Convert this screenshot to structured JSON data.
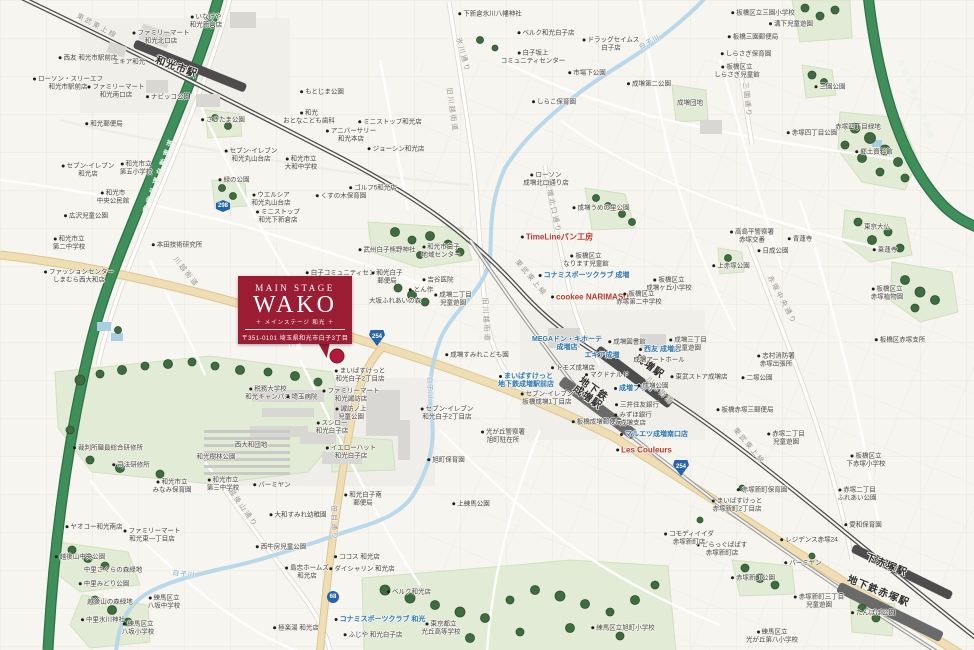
{
  "callout": {
    "en_small": "MAIN STAGE",
    "en_large": "WAKO",
    "subtitle": "＋ メインステージ 和光 ＋",
    "address": "〒351-0101 埼玉県和光市白子3丁目10番"
  },
  "colors": {
    "brand_red": "#9a1d34",
    "shop_blue": "#2878b4",
    "accent_red": "#c0392b",
    "expressway_green": "#3f8f5b",
    "railway_gray": "#4c4c4c",
    "river_blue": "#b5d6e8",
    "park_green": "#e2ebd5",
    "road_badge_blue": "#2563ab"
  },
  "badges": [
    {
      "t": "298",
      "shape": "hex",
      "x": 223,
      "y": 206
    },
    {
      "t": "254",
      "shape": "tri",
      "x": 377,
      "y": 338
    },
    {
      "t": "254",
      "shape": "tri",
      "x": 681,
      "y": 468
    },
    {
      "t": "68",
      "shape": "circle",
      "x": 333,
      "y": 597
    }
  ],
  "labels": [
    {
      "t": "和光市駅",
      "x": 176,
      "y": 68,
      "c": "station",
      "r": 20
    },
    {
      "t": "成増駅",
      "x": 649,
      "y": 367,
      "c": "station",
      "r": 36
    },
    {
      "t": "地下鉄\n成増駅",
      "x": 590,
      "y": 394,
      "c": "station",
      "r": 36
    },
    {
      "t": "下赤塚駅",
      "x": 886,
      "y": 566,
      "c": "station",
      "r": 22
    },
    {
      "t": "地下鉄赤塚駅",
      "x": 878,
      "y": 592,
      "c": "station",
      "r": 22
    },
    {
      "t": "東武東上線",
      "x": 97,
      "y": 26,
      "c": "road",
      "r": 28
    },
    {
      "t": "東武東上線",
      "x": 531,
      "y": 278,
      "c": "road",
      "r": 50
    },
    {
      "t": "東武東上線",
      "x": 749,
      "y": 446,
      "c": "road",
      "r": 50
    },
    {
      "t": "川越街道",
      "x": 186,
      "y": 272,
      "c": "road",
      "r": 52
    },
    {
      "t": "川越街道",
      "x": 660,
      "y": 391,
      "c": "road",
      "r": 45
    },
    {
      "t": "旧川越街道",
      "x": 452,
      "y": 110,
      "c": "road",
      "r": 82
    },
    {
      "t": "旧川越街道",
      "x": 486,
      "y": 320,
      "c": "road",
      "r": 87
    },
    {
      "t": "笹目通り",
      "x": 334,
      "y": 523,
      "c": "road",
      "r": 88
    },
    {
      "t": "氷川通り",
      "x": 463,
      "y": 55,
      "c": "road",
      "r": 75
    },
    {
      "t": "成増北口通り",
      "x": 553,
      "y": 207,
      "c": "road",
      "r": 78
    },
    {
      "t": "三園通り",
      "x": 747,
      "y": 100,
      "c": "road",
      "r": 84
    },
    {
      "t": "赤塚中央通り",
      "x": 782,
      "y": 300,
      "c": "road",
      "r": 62
    },
    {
      "t": "越後山通り",
      "x": 243,
      "y": 508,
      "c": "road",
      "r": 55
    },
    {
      "t": "東京外環自動車道",
      "x": 159,
      "y": 175,
      "c": "hwy",
      "r": -70
    },
    {
      "t": "首都高速5号池袋線",
      "x": 916,
      "y": 100,
      "c": "hwy",
      "r": 68
    },
    {
      "t": "白子川",
      "x": 649,
      "y": 41,
      "c": "river",
      "r": -30
    },
    {
      "t": "白子川",
      "x": 431,
      "y": 388,
      "c": "river",
      "r": 88
    },
    {
      "t": "白子川",
      "x": 184,
      "y": 573,
      "c": "river",
      "r": 6
    },
    {
      "t": "MEGAドン・キホーテ\n成増店",
      "x": 567,
      "y": 344,
      "c": "shop"
    },
    {
      "t": "エキア成増",
      "x": 602,
      "y": 356,
      "c": "shop"
    },
    {
      "t": "西友 成増店",
      "x": 660,
      "y": 350,
      "c": "shop",
      "d": 1
    },
    {
      "t": "成増プラザ",
      "x": 634,
      "y": 389,
      "c": "shop",
      "d": 1
    },
    {
      "t": "まいばすけっと\n地下鉄成増駅前店",
      "x": 526,
      "y": 381,
      "c": "shop",
      "d": 1
    },
    {
      "t": "マルエツ成増南口店",
      "x": 654,
      "y": 435,
      "c": "shop",
      "d": 1
    },
    {
      "t": "コナミスポーツクラブ 成増",
      "x": 584,
      "y": 276,
      "c": "shop",
      "d": 1
    },
    {
      "t": "コナミスポーツクラブ 和光",
      "x": 380,
      "y": 620,
      "c": "shop",
      "d": 1
    },
    {
      "t": "TimeLineパン工房",
      "x": 557,
      "y": 237,
      "c": "red",
      "d": 1
    },
    {
      "t": "cookee NARIMASU",
      "x": 590,
      "y": 297,
      "c": "red",
      "d": 1
    },
    {
      "t": "Les Couleurs",
      "x": 644,
      "y": 450,
      "c": "red",
      "d": 1
    },
    {
      "t": "いなげや\n和光新倉店",
      "x": 206,
      "y": 21,
      "c": "poi",
      "d": 1
    },
    {
      "t": "ファミリーマート\n和光北口店",
      "x": 161,
      "y": 37,
      "c": "poi",
      "d": 1
    },
    {
      "t": "西友 和光市駅前店",
      "x": 88,
      "y": 58,
      "c": "poi",
      "d": 1
    },
    {
      "t": "エキア和光",
      "x": 129,
      "y": 62,
      "c": "poi"
    },
    {
      "t": "ローソン・スリーエフ\n和光市駅前店",
      "x": 68,
      "y": 83,
      "c": "poi",
      "d": 1
    },
    {
      "t": "ファミリーマート\n和光南口店",
      "x": 116,
      "y": 91,
      "c": "poi",
      "d": 1
    },
    {
      "t": "和光郵便局",
      "x": 104,
      "y": 124,
      "c": "poi",
      "d": 1
    },
    {
      "t": "ナビッコ公園",
      "x": 168,
      "y": 97,
      "c": "poi",
      "d": 1
    },
    {
      "t": "もとじま公園",
      "x": 322,
      "y": 92,
      "c": "poi",
      "d": 1
    },
    {
      "t": "下新倉氷川八幡神社",
      "x": 490,
      "y": 14,
      "c": "poi",
      "d": 1
    },
    {
      "t": "ベルク和光白子店",
      "x": 546,
      "y": 33,
      "c": "poi",
      "d": 1
    },
    {
      "t": "白子坂上\nコミュニティセンター",
      "x": 533,
      "y": 57,
      "c": "poi",
      "d": 1
    },
    {
      "t": "ドラッグセイムス\n白子店",
      "x": 611,
      "y": 44,
      "c": "poi",
      "d": 1
    },
    {
      "t": "市場下公園",
      "x": 587,
      "y": 73,
      "c": "poi",
      "d": 1
    },
    {
      "t": "しらこ保育園",
      "x": 554,
      "y": 102,
      "c": "poi",
      "d": 1
    },
    {
      "t": "成増第二公園",
      "x": 649,
      "y": 84,
      "c": "poi",
      "d": 1
    },
    {
      "t": "成増団地",
      "x": 690,
      "y": 103,
      "c": "poi"
    },
    {
      "t": "板橋区立三園小学校",
      "x": 763,
      "y": 13,
      "c": "poi",
      "d": 1
    },
    {
      "t": "溝下児童遊園",
      "x": 791,
      "y": 24,
      "c": "poi",
      "d": 1
    },
    {
      "t": "板橋三園郵便局",
      "x": 753,
      "y": 37,
      "c": "poi",
      "d": 1
    },
    {
      "t": "しらさぎ保育園",
      "x": 746,
      "y": 54,
      "c": "poi",
      "d": 1
    },
    {
      "t": "板橋区立\nしらさぎ児童館",
      "x": 737,
      "y": 71,
      "c": "poi",
      "d": 1
    },
    {
      "t": "三園公園",
      "x": 830,
      "y": 87,
      "c": "poi",
      "d": 1
    },
    {
      "t": "赤塚四丁目公園",
      "x": 812,
      "y": 133,
      "c": "poi",
      "d": 1
    },
    {
      "t": "赤塚四丁目緑地",
      "x": 858,
      "y": 127,
      "c": "poi"
    },
    {
      "t": "郷土資料館",
      "x": 874,
      "y": 152,
      "c": "poi",
      "d": 1
    },
    {
      "t": "東京大仏",
      "x": 877,
      "y": 227,
      "c": "poi"
    },
    {
      "t": "乗蓮寺",
      "x": 885,
      "y": 250,
      "c": "poi",
      "d": 1
    },
    {
      "t": "青蓮寺",
      "x": 800,
      "y": 239,
      "c": "poi",
      "d": 1
    },
    {
      "t": "高島平警察署\n赤塚交番",
      "x": 752,
      "y": 236,
      "c": "poi",
      "d": 1
    },
    {
      "t": "日成公園",
      "x": 773,
      "y": 251,
      "c": "poi",
      "d": 1
    },
    {
      "t": "板橋区立\n赤塚植物園",
      "x": 887,
      "y": 293,
      "c": "poi",
      "d": 1
    },
    {
      "t": "板橋区赤塚支所",
      "x": 900,
      "y": 340,
      "c": "poi",
      "d": 1
    },
    {
      "t": "志村消防署\n赤塚出張所",
      "x": 776,
      "y": 360,
      "c": "poi",
      "d": 1
    },
    {
      "t": "二塚公園",
      "x": 757,
      "y": 378,
      "c": "poi",
      "d": 1
    },
    {
      "t": "板橋赤塚三郵便局",
      "x": 745,
      "y": 410,
      "c": "poi",
      "d": 1
    },
    {
      "t": "赤塚二丁目\n児童遊園",
      "x": 786,
      "y": 438,
      "c": "poi",
      "d": 1
    },
    {
      "t": "板橋区立\n下赤塚小学校",
      "x": 866,
      "y": 460,
      "c": "poi",
      "d": 1
    },
    {
      "t": "赤塚新町保育園",
      "x": 762,
      "y": 490,
      "c": "poi",
      "d": 1
    },
    {
      "t": "まいばすけっと\n赤塚新町2丁目店",
      "x": 737,
      "y": 505,
      "c": "poi",
      "d": 1
    },
    {
      "t": "赤塚二丁目\nふれあい公園",
      "x": 857,
      "y": 494,
      "c": "poi",
      "d": 1
    },
    {
      "t": "愛和保育園",
      "x": 863,
      "y": 525,
      "c": "poi",
      "d": 1
    },
    {
      "t": "レジデンス赤塚24",
      "x": 809,
      "y": 540,
      "c": "poi",
      "d": 1
    },
    {
      "t": "どらっぐぱぱす\n赤塚新町店",
      "x": 722,
      "y": 549,
      "c": "poi",
      "d": 1
    },
    {
      "t": "コモディイイダ\n赤塚新町店",
      "x": 689,
      "y": 538,
      "c": "poi",
      "d": 1
    },
    {
      "t": "バーミヤン",
      "x": 803,
      "y": 563,
      "c": "poi",
      "d": 1
    },
    {
      "t": "赤塚新町公園",
      "x": 753,
      "y": 578,
      "c": "poi",
      "d": 1
    },
    {
      "t": "赤塚新町三丁目\n児童遊園",
      "x": 819,
      "y": 601,
      "c": "poi",
      "d": 1
    },
    {
      "t": "たんぽぽ公園",
      "x": 873,
      "y": 613,
      "c": "poi",
      "d": 1
    },
    {
      "t": "練馬区立\n光が丘第八小学校",
      "x": 772,
      "y": 636,
      "c": "poi",
      "d": 1
    },
    {
      "t": "成増図書館",
      "x": 627,
      "y": 342,
      "c": "poi",
      "d": 1
    },
    {
      "t": "成増アートホール",
      "x": 659,
      "y": 360,
      "c": "poi"
    },
    {
      "t": "トモズ成増店",
      "x": 573,
      "y": 368,
      "c": "poi",
      "d": 1
    },
    {
      "t": "マクドナルド",
      "x": 607,
      "y": 375,
      "c": "poi",
      "d": 1
    },
    {
      "t": "三井住友銀行",
      "x": 637,
      "y": 405,
      "c": "poi",
      "d": 1
    },
    {
      "t": "みずほ銀行\n成増支店",
      "x": 633,
      "y": 419,
      "c": "poi",
      "d": 1
    },
    {
      "t": "セブン-イレブン\n板橋成増1丁目店",
      "x": 547,
      "y": 398,
      "c": "poi",
      "d": 1
    },
    {
      "t": "板橋成増郵便局",
      "x": 597,
      "y": 422,
      "c": "poi",
      "d": 1
    },
    {
      "t": "成増公園",
      "x": 653,
      "y": 386,
      "c": "poi",
      "d": 1
    },
    {
      "t": "東武ストア成増店",
      "x": 699,
      "y": 377,
      "c": "poi",
      "d": 1
    },
    {
      "t": "成増三丁目\n児童遊園",
      "x": 688,
      "y": 344,
      "c": "poi",
      "d": 1
    },
    {
      "t": "ローソン\n成増北口通り店",
      "x": 546,
      "y": 179,
      "c": "poi",
      "d": 1
    },
    {
      "t": "成増うめの里公園",
      "x": 601,
      "y": 208,
      "c": "poi",
      "d": 1
    },
    {
      "t": "板橋区立\nなります児童館",
      "x": 586,
      "y": 260,
      "c": "poi",
      "d": 1
    },
    {
      "t": "板橋区立\n成増ヶ丘小学校",
      "x": 669,
      "y": 284,
      "c": "poi",
      "d": 1
    },
    {
      "t": "板橋区立\n赤塚第二中学校",
      "x": 639,
      "y": 298,
      "c": "poi",
      "d": 1
    },
    {
      "t": "上赤塚公園",
      "x": 731,
      "y": 266,
      "c": "poi",
      "d": 1
    },
    {
      "t": "成増二丁目\n児童遊園",
      "x": 453,
      "y": 299,
      "c": "poi",
      "d": 1
    },
    {
      "t": "武州白子熊野神社",
      "x": 387,
      "y": 250,
      "c": "poi",
      "d": 1
    },
    {
      "t": "和光市白子\n地域センター",
      "x": 441,
      "y": 251,
      "c": "poi",
      "d": 1
    },
    {
      "t": "白子コミュニティセンター",
      "x": 347,
      "y": 273,
      "c": "poi",
      "d": 1
    },
    {
      "t": "和光白子\n郵便局",
      "x": 387,
      "y": 277,
      "c": "poi",
      "d": 1
    },
    {
      "t": "吉谷医院",
      "x": 438,
      "y": 280,
      "c": "poi",
      "d": 1
    },
    {
      "t": "とん作",
      "x": 421,
      "y": 290,
      "c": "poi",
      "d": 1
    },
    {
      "t": "大坂ふれあいの森",
      "x": 395,
      "y": 301,
      "c": "poi"
    },
    {
      "t": "まいばすけっと\n和光白子2丁目店",
      "x": 360,
      "y": 375,
      "c": "poi",
      "d": 1
    },
    {
      "t": "ファミリーマート\n和光諏訪店",
      "x": 351,
      "y": 395,
      "c": "poi",
      "d": 1
    },
    {
      "t": "諏訪ノ上\n児童公園",
      "x": 351,
      "y": 413,
      "c": "poi",
      "d": 1
    },
    {
      "t": "スシロー\n和光白子店",
      "x": 332,
      "y": 427,
      "c": "poi",
      "d": 1
    },
    {
      "t": "イエローハット\n和光白子店",
      "x": 351,
      "y": 452,
      "c": "poi",
      "d": 1
    },
    {
      "t": "セブン-イレブン\n和光白子2丁目店",
      "x": 447,
      "y": 413,
      "c": "poi",
      "d": 1
    },
    {
      "t": "旭町保育園",
      "x": 446,
      "y": 460,
      "c": "poi",
      "d": 1
    },
    {
      "t": "成増すみれこども園",
      "x": 477,
      "y": 355,
      "c": "poi",
      "d": 1
    },
    {
      "t": "光が丘警察署\n旭町駐在所",
      "x": 503,
      "y": 436,
      "c": "poi",
      "d": 1
    },
    {
      "t": "税務大学校\n和光キャンパス",
      "x": 268,
      "y": 393,
      "c": "poi",
      "d": 1
    },
    {
      "t": "埼玉病院",
      "x": 302,
      "y": 397,
      "c": "poi",
      "d": 1
    },
    {
      "t": "裁判所職員総合研修所",
      "x": 108,
      "y": 448,
      "c": "poi",
      "d": 1
    },
    {
      "t": "司法研修所",
      "x": 131,
      "y": 465,
      "c": "poi",
      "d": 1
    },
    {
      "t": "和光市立\nみなみ保育園",
      "x": 172,
      "y": 486,
      "c": "poi",
      "d": 1
    },
    {
      "t": "和光市立\n第三中学校",
      "x": 223,
      "y": 484,
      "c": "poi",
      "d": 1
    },
    {
      "t": "和光樹林公園",
      "x": 216,
      "y": 457,
      "c": "poi"
    },
    {
      "t": "西大和団地",
      "x": 251,
      "y": 445,
      "c": "poi"
    },
    {
      "t": "ヤオコー和光南店",
      "x": 94,
      "y": 527,
      "c": "poi",
      "d": 1
    },
    {
      "t": "ファミリーマート\n和光東一丁目店",
      "x": 152,
      "y": 535,
      "c": "poi",
      "d": 1
    },
    {
      "t": "越後山中央公園",
      "x": 80,
      "y": 557,
      "c": "poi",
      "d": 1
    },
    {
      "t": "中里さくらの森緑地",
      "x": 113,
      "y": 570,
      "c": "poi"
    },
    {
      "t": "中里みどり公園",
      "x": 104,
      "y": 584,
      "c": "poi",
      "d": 1
    },
    {
      "t": "越後山の森緑地",
      "x": 110,
      "y": 602,
      "c": "poi"
    },
    {
      "t": "中里氷川神社",
      "x": 103,
      "y": 620,
      "c": "poi",
      "d": 1
    },
    {
      "t": "練馬区立\n八坂中学校",
      "x": 164,
      "y": 602,
      "c": "poi",
      "d": 1
    },
    {
      "t": "練馬区立\n八坂小学校",
      "x": 138,
      "y": 628,
      "c": "poi",
      "d": 1
    },
    {
      "t": "バーミヤン",
      "x": 272,
      "y": 485,
      "c": "poi",
      "d": 1
    },
    {
      "t": "大和すみれ幼稚園",
      "x": 298,
      "y": 515,
      "c": "poi",
      "d": 1
    },
    {
      "t": "和光白子南\n郵便局",
      "x": 363,
      "y": 499,
      "c": "poi",
      "d": 1
    },
    {
      "t": "西牛房児童公園",
      "x": 281,
      "y": 547,
      "c": "poi",
      "d": 1
    },
    {
      "t": "島忠ホームズ\n和光店",
      "x": 307,
      "y": 572,
      "c": "poi",
      "d": 1
    },
    {
      "t": "ココス 和光店",
      "x": 357,
      "y": 557,
      "c": "poi",
      "d": 1
    },
    {
      "t": "ダイシャリン 和光店",
      "x": 362,
      "y": 569,
      "c": "poi",
      "d": 1
    },
    {
      "t": "ベルク和光店",
      "x": 409,
      "y": 592,
      "c": "poi",
      "d": 1
    },
    {
      "t": "東京都立\n光丘高等学校",
      "x": 441,
      "y": 628,
      "c": "poi",
      "d": 1
    },
    {
      "t": "ふじや 和光白子店",
      "x": 373,
      "y": 635,
      "c": "poi",
      "d": 1
    },
    {
      "t": "極楽湯 和光店",
      "x": 296,
      "y": 628,
      "c": "poi",
      "d": 1
    },
    {
      "t": "上練馬公園",
      "x": 471,
      "y": 504,
      "c": "poi",
      "d": 1
    },
    {
      "t": "練馬区立旭町小学校",
      "x": 623,
      "y": 628,
      "c": "poi",
      "d": 1
    },
    {
      "t": "セブン-イレブン\n和光店",
      "x": 88,
      "y": 170,
      "c": "poi",
      "d": 1
    },
    {
      "t": "和光市立\n第五小学校",
      "x": 136,
      "y": 168,
      "c": "poi",
      "d": 1
    },
    {
      "t": "和光市\n中央公民館",
      "x": 113,
      "y": 197,
      "c": "poi",
      "d": 1
    },
    {
      "t": "広沢児童公園",
      "x": 86,
      "y": 216,
      "c": "poi",
      "d": 1
    },
    {
      "t": "和光市立\n第二中学校",
      "x": 69,
      "y": 243,
      "c": "poi",
      "d": 1
    },
    {
      "t": "本田技術研究所",
      "x": 177,
      "y": 245,
      "c": "poi",
      "d": 1
    },
    {
      "t": "ファッションセンター\nしまむら西大和店",
      "x": 79,
      "y": 276,
      "c": "poi",
      "d": 1
    },
    {
      "t": "緑の公園",
      "x": 234,
      "y": 180,
      "c": "poi",
      "d": 1
    },
    {
      "t": "さきたま公園",
      "x": 223,
      "y": 120,
      "c": "poi",
      "d": 1
    },
    {
      "t": "セブン-イレブン\n和光丸山台店",
      "x": 251,
      "y": 155,
      "c": "poi",
      "d": 1
    },
    {
      "t": "和光市立\n大和中学校",
      "x": 301,
      "y": 163,
      "c": "poi",
      "d": 1
    },
    {
      "t": "和光\nおとなこども歯科",
      "x": 309,
      "y": 117,
      "c": "poi",
      "d": 1
    },
    {
      "t": "アニバーサリー\n和光本店",
      "x": 351,
      "y": 135,
      "c": "poi",
      "d": 1
    },
    {
      "t": "ミニストップ和光店",
      "x": 390,
      "y": 122,
      "c": "poi",
      "d": 1
    },
    {
      "t": "ジョーシン和光店",
      "x": 396,
      "y": 149,
      "c": "poi",
      "d": 1
    },
    {
      "t": "ウエルシア\n和光丸山台店",
      "x": 271,
      "y": 199,
      "c": "poi",
      "d": 1
    },
    {
      "t": "ミニストップ\n和光下新倉店",
      "x": 278,
      "y": 216,
      "c": "poi",
      "d": 1
    },
    {
      "t": "ゴルフ5和光店",
      "x": 373,
      "y": 188,
      "c": "poi",
      "d": 1
    },
    {
      "t": "くすの木保育園",
      "x": 341,
      "y": 196,
      "c": "poi",
      "d": 1
    }
  ]
}
